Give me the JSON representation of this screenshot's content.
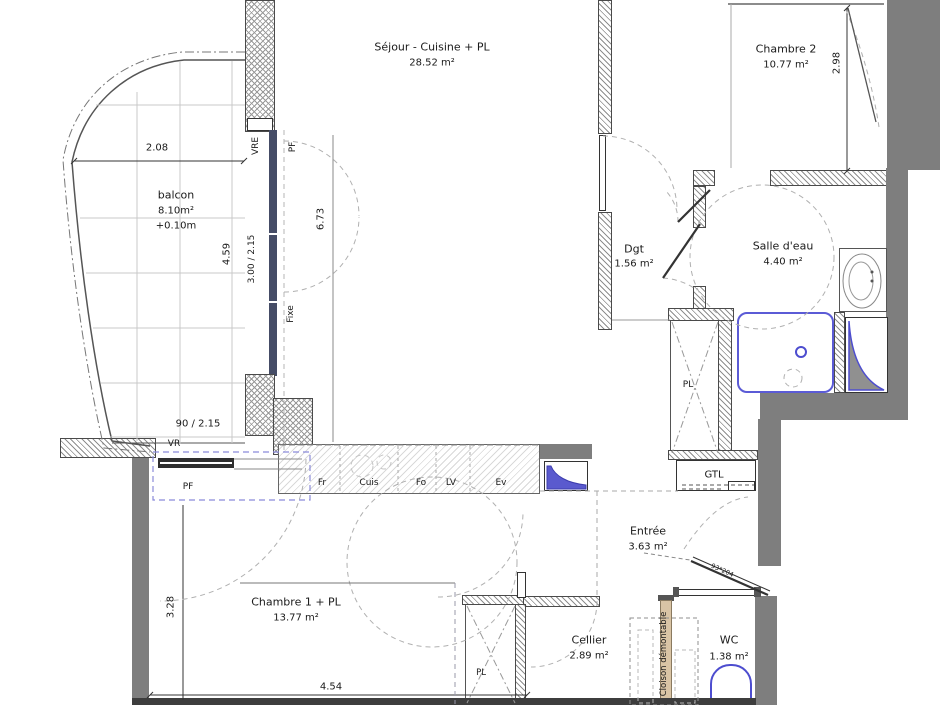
{
  "rooms": {
    "sejour": {
      "name": "Séjour - Cuisine + PL",
      "area": "28.52 m²"
    },
    "chambre2": {
      "name": "Chambre 2",
      "area": "10.77 m²"
    },
    "balcon": {
      "name": "balcon",
      "area": "8.10m²",
      "level": "+0.10m"
    },
    "dgt": {
      "name": "Dgt",
      "area": "1.56 m²"
    },
    "salle_eau": {
      "name": "Salle d'eau",
      "area": "4.40 m²"
    },
    "entree": {
      "name": "Entrée",
      "area": "3.63 m²"
    },
    "chambre1": {
      "name": "Chambre 1 + PL",
      "area": "13.77 m²"
    },
    "cellier": {
      "name": "Cellier",
      "area": "2.89 m²"
    },
    "wc": {
      "name": "WC",
      "area": "1.38 m²"
    }
  },
  "dimensions": {
    "balcon_width": "2.08",
    "balcon_depth": "4.59",
    "sejour_window": "3.00 / 2.15",
    "sejour_length": "6.73",
    "chambre2_width": "2.98",
    "chambre1_window": "90 / 2.15",
    "chambre1_depth": "3.28",
    "chambre1_width": "4.54"
  },
  "openings": {
    "vre": "VRE",
    "pf_top": "PF",
    "fixe": "Fixe",
    "vr": "VR",
    "pf_bottom": "PF",
    "entry_door_size": "93*204"
  },
  "kitchen": {
    "fr": "Fr",
    "cuis": "Cuis",
    "fo": "Fo",
    "lv": "LV",
    "ev": "Ev"
  },
  "features": {
    "pl_top": "PL",
    "pl_bottom": "PL",
    "gtl": "GTL",
    "cloison": "Cloison démontable"
  },
  "colors": {
    "wall_gray": "#7e7e7e",
    "fixture_blue": "#4d4dcf",
    "window_frame": "#454c66",
    "partition_tan": "#d9c4a5"
  }
}
